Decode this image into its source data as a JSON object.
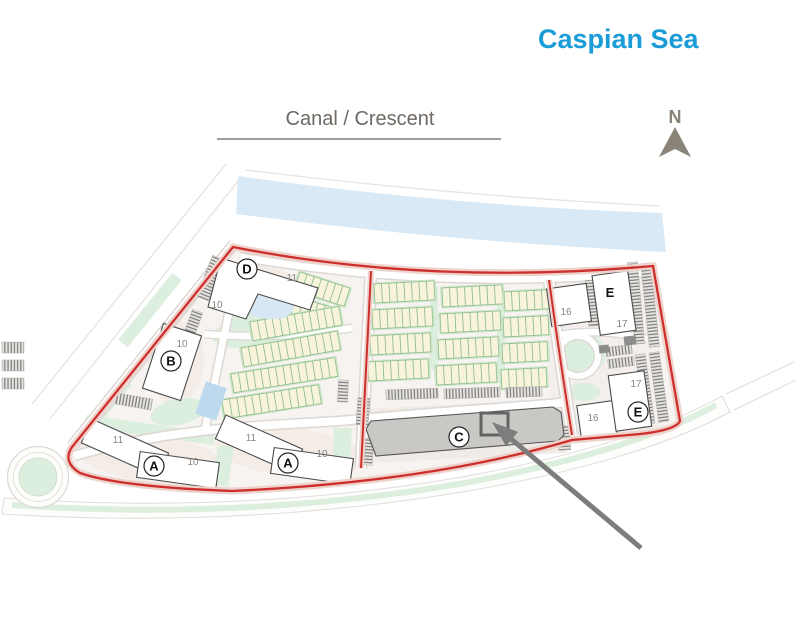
{
  "header": {
    "sea_label": "Caspian Sea",
    "canal_label": "Canal / Crescent",
    "north_label": "N"
  },
  "colors": {
    "sea_text": "#1a9cd9",
    "canal_text": "#6e6963",
    "canal_rule": "#a09c97",
    "north": "#8a8478",
    "boundary": "#ce2f2c",
    "boundary_halo": "#eed2cc",
    "water": "#d9eaf6",
    "parcel": "#f7f3f0",
    "pink_zone": "#f3ece7",
    "green": "#dceedd",
    "green_strip": "#cfe6cb",
    "th_fill": "#f7f4db",
    "th_stroke": "#8fbd8f",
    "pool": "#bcd9ee",
    "pond": "#d7e7f3",
    "c_fill": "#c9c8c5",
    "building_stroke": "#4a4a4a",
    "road_casing": "#dbd7d3",
    "marker_number": "#8a857f",
    "arrow": "#7d7d7d",
    "highlight_box": "#646464"
  },
  "map": {
    "building_markers": [
      {
        "letter": "D",
        "circled": true
      },
      {
        "letter": "B",
        "circled": true
      },
      {
        "letter": "A",
        "circled": true
      },
      {
        "letter": "A",
        "circled": true
      },
      {
        "letter": "C",
        "circled": true
      },
      {
        "letter": "E",
        "circled": false
      },
      {
        "letter": "E",
        "circled": true
      }
    ],
    "plot_numbers": [
      {
        "value": "11"
      },
      {
        "value": "10"
      },
      {
        "value": "10"
      },
      {
        "value": "11"
      },
      {
        "value": "10"
      },
      {
        "value": "11"
      },
      {
        "value": "10"
      },
      {
        "value": "16"
      },
      {
        "value": "17"
      },
      {
        "value": "17"
      },
      {
        "value": "16"
      }
    ]
  }
}
